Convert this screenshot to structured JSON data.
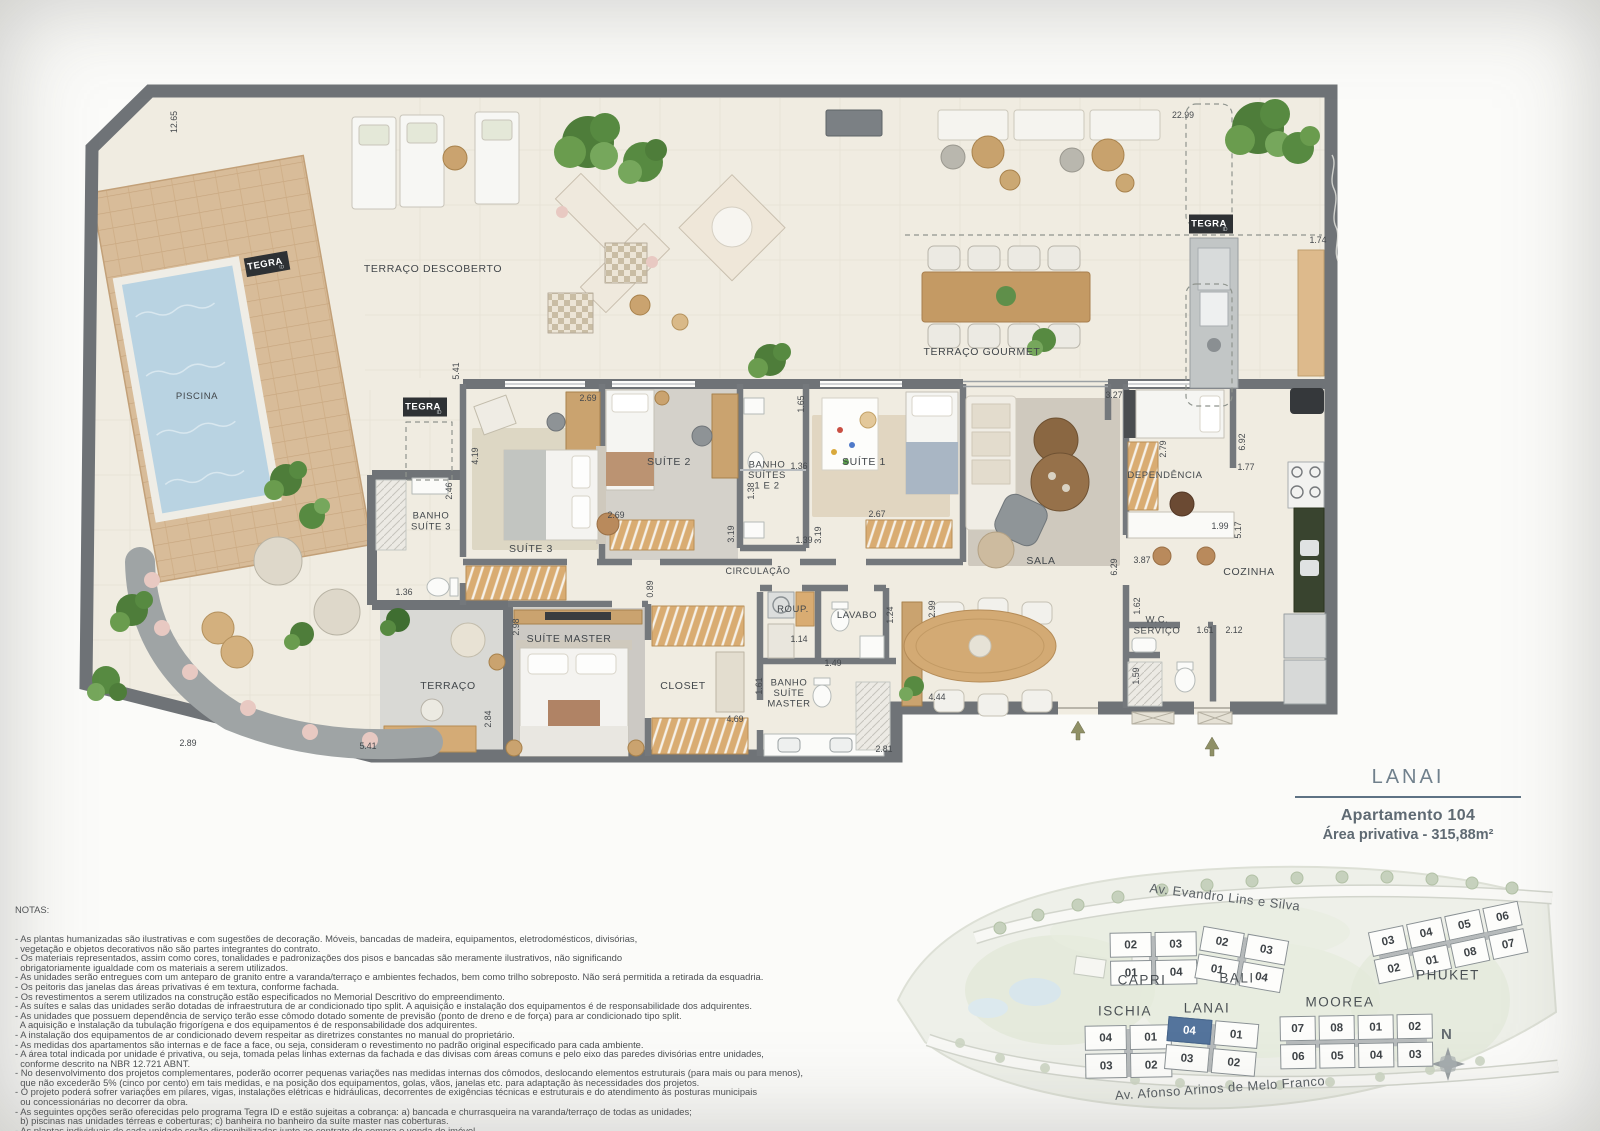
{
  "title_block": {
    "building": "LANAI",
    "apartment": "Apartamento 104",
    "area": "Área privativa - 315,88m²"
  },
  "notes": {
    "heading": "NOTAS:",
    "lines": [
      "- As plantas humanizadas são ilustrativas e com sugestões de decoração. Móveis, bancadas de madeira, equipamentos, eletrodomésticos, divisórias,",
      "  vegetação e objetos decorativos não são partes integrantes do contrato.",
      "- Os materiais representados, assim como cores, tonalidades e padronizações dos pisos e bancadas são meramente ilustrativos, não significando",
      "  obrigatoriamente igualdade com os materiais a serem utilizados.",
      "- As unidades serão entregues com um anteparo de granito entre a varanda/terraço e ambientes fechados, bem como trilho sobreposto. Não será permitida a retirada da esquadria.",
      "- Os peitoris das janelas das áreas privativas é em textura, conforme fachada.",
      "- Os revestimentos a serem utilizados na construção estão especificados no Memorial Descritivo do empreendimento.",
      "- As suítes e salas das unidades serão dotadas de infraestrutura de ar condicionado tipo split. A aquisição e instalação dos equipamentos é de responsabilidade dos adquirentes.",
      "- As unidades que possuem dependência de serviço terão esse cômodo dotado somente de previsão (ponto de dreno e de força) para ar condicionado tipo split.",
      "  A aquisição e instalação da tubulação frigorígena e dos equipamentos é de responsabilidade dos adquirentes.",
      "- A instalação dos equipamentos de ar condicionado devem respeitar as diretrizes constantes no manual do proprietário.",
      "- As medidas dos apartamentos são internas e de face a face, ou seja, consideram o revestimento no padrão original especificado para cada ambiente.",
      "- A área total indicada por unidade é privativa, ou seja, tomada pelas linhas externas da fachada e das divisas com áreas comuns e pelo eixo das paredes divisórias entre unidades,",
      "  conforme descrito na NBR 12.721 ABNT.",
      "- No desenvolvimento dos projetos complementares, poderão ocorrer pequenas variações nas medidas internas dos cômodos, deslocando elementos estruturais (para mais ou para menos),",
      "  que não excederão 5% (cinco por cento) em tais medidas, e na posição dos equipamentos, golas, vãos, janelas etc. para adaptação às necessidades dos projetos.",
      "- O projeto poderá sofrer variações em pilares, vigas, instalações elétricas e hidráulicas, decorrentes de exigências técnicas e estruturais e do atendimento às posturas municipais",
      "  ou concessionárias no decorrer da obra.",
      "- As seguintes opções serão oferecidas pelo programa Tegra ID e estão sujeitas a cobrança: a) bancada e churrasqueira na varanda/terraço de todas as unidades;",
      "  b) piscinas nas unidades térreas e coberturas; c) banheira no banheiro da suíte master nas coberturas.",
      "- As plantas individuais de cada unidade serão disponibilizadas junto ao contrato de compra e venda do imóvel."
    ]
  },
  "floorplan": {
    "logos": [
      {
        "text": "TEGRA",
        "sub": "ID",
        "x": 267,
        "y": 264,
        "rot": -10
      },
      {
        "text": "TEGRA",
        "sub": "ID",
        "x": 425,
        "y": 407,
        "rot": 0
      },
      {
        "text": "TEGRA",
        "sub": "ID",
        "x": 1211,
        "y": 224,
        "rot": 0
      }
    ],
    "room_labels": [
      {
        "lines": [
          "TERRAÇO DESCOBERTO"
        ],
        "x": 433,
        "y": 272
      },
      {
        "lines": [
          "PISCINA"
        ],
        "x": 197,
        "y": 399,
        "fs": 9.5
      },
      {
        "lines": [
          "TERRAÇO GOURMET"
        ],
        "x": 982,
        "y": 355
      },
      {
        "lines": [
          "BANHO",
          "SUÍTE 3"
        ],
        "x": 431,
        "y": 524,
        "fs": 9.5
      },
      {
        "lines": [
          "SUÍTE 3"
        ],
        "x": 531,
        "y": 552
      },
      {
        "lines": [
          "SUÍTE 2"
        ],
        "x": 669,
        "y": 465
      },
      {
        "lines": [
          "BANHO",
          "SUÍTES",
          "1 E 2"
        ],
        "x": 767,
        "y": 478,
        "fs": 9.5
      },
      {
        "lines": [
          "SUÍTE 1"
        ],
        "x": 864,
        "y": 465
      },
      {
        "lines": [
          "CIRCULAÇÃO"
        ],
        "x": 758,
        "y": 574,
        "fs": 9
      },
      {
        "lines": [
          "SALA"
        ],
        "x": 1041,
        "y": 564
      },
      {
        "lines": [
          "DEPENDÊNCIA"
        ],
        "x": 1165,
        "y": 478,
        "fs": 9.5
      },
      {
        "lines": [
          "COZINHA"
        ],
        "x": 1249,
        "y": 575
      },
      {
        "lines": [
          "W.C.",
          "SERVIÇO"
        ],
        "x": 1157,
        "y": 628,
        "fs": 9.5
      },
      {
        "lines": [
          "LAVABO"
        ],
        "x": 857,
        "y": 618,
        "fs": 9.5
      },
      {
        "lines": [
          "ROUP."
        ],
        "x": 793,
        "y": 612,
        "fs": 9.5
      },
      {
        "lines": [
          "TERRAÇO"
        ],
        "x": 448,
        "y": 689
      },
      {
        "lines": [
          "SUÍTE MASTER"
        ],
        "x": 569,
        "y": 642
      },
      {
        "lines": [
          "CLOSET"
        ],
        "x": 683,
        "y": 689
      },
      {
        "lines": [
          "BANHO",
          "SUÍTE",
          "MASTER"
        ],
        "x": 789,
        "y": 696,
        "fs": 9.5
      }
    ],
    "dim_labels": [
      {
        "t": "12.65",
        "x": 177,
        "y": 122,
        "rot": -90
      },
      {
        "t": "22.99",
        "x": 1183,
        "y": 118
      },
      {
        "t": "1.74",
        "x": 1318,
        "y": 243
      },
      {
        "t": "5.41",
        "x": 459,
        "y": 371,
        "rot": -90
      },
      {
        "t": "2.69",
        "x": 588,
        "y": 401
      },
      {
        "t": "4.19",
        "x": 478,
        "y": 456,
        "rot": -90
      },
      {
        "t": "2.46",
        "x": 452,
        "y": 491,
        "rot": -90
      },
      {
        "t": "1.36",
        "x": 404,
        "y": 595
      },
      {
        "t": "2.69",
        "x": 616,
        "y": 518
      },
      {
        "t": "1.65",
        "x": 804,
        "y": 404,
        "rot": -90
      },
      {
        "t": "1.36",
        "x": 799,
        "y": 469
      },
      {
        "t": "1.39",
        "x": 804,
        "y": 543
      },
      {
        "t": "1.38",
        "x": 754,
        "y": 491,
        "rot": -90
      },
      {
        "t": "3.19",
        "x": 734,
        "y": 534,
        "rot": -90
      },
      {
        "t": "3.19",
        "x": 821,
        "y": 535,
        "rot": -90
      },
      {
        "t": "2.67",
        "x": 877,
        "y": 517
      },
      {
        "t": "3.27",
        "x": 1114,
        "y": 398
      },
      {
        "t": "2.79",
        "x": 1166,
        "y": 449,
        "rot": -90
      },
      {
        "t": "6.92",
        "x": 1245,
        "y": 442,
        "rot": -90
      },
      {
        "t": "1.77",
        "x": 1246,
        "y": 470
      },
      {
        "t": "1.99",
        "x": 1220,
        "y": 529
      },
      {
        "t": "5.17",
        "x": 1241,
        "y": 530,
        "rot": -90
      },
      {
        "t": "3.87",
        "x": 1142,
        "y": 563
      },
      {
        "t": "6.29",
        "x": 1117,
        "y": 567,
        "rot": -90
      },
      {
        "t": "1.62",
        "x": 1140,
        "y": 606,
        "rot": -90
      },
      {
        "t": "1.61",
        "x": 1205,
        "y": 633
      },
      {
        "t": "2.12",
        "x": 1234,
        "y": 633
      },
      {
        "t": "1.59",
        "x": 1139,
        "y": 676,
        "rot": -90
      },
      {
        "t": "2.99",
        "x": 935,
        "y": 609,
        "rot": -90
      },
      {
        "t": "1.24",
        "x": 893,
        "y": 615,
        "rot": -90
      },
      {
        "t": "1.14",
        "x": 799,
        "y": 642
      },
      {
        "t": "1.49",
        "x": 833,
        "y": 666
      },
      {
        "t": "4.44",
        "x": 937,
        "y": 700
      },
      {
        "t": "4.69",
        "x": 735,
        "y": 722
      },
      {
        "t": "1.61",
        "x": 762,
        "y": 686,
        "rot": -90
      },
      {
        "t": "2.81",
        "x": 884,
        "y": 752
      },
      {
        "t": "2.84",
        "x": 491,
        "y": 719,
        "rot": -90
      },
      {
        "t": "2.98",
        "x": 519,
        "y": 627,
        "rot": -90
      },
      {
        "t": "0.89",
        "x": 653,
        "y": 589,
        "rot": -90
      },
      {
        "t": "2.89",
        "x": 188,
        "y": 746
      },
      {
        "t": "5.41",
        "x": 368,
        "y": 749
      }
    ]
  },
  "sitemap": {
    "compass_label": "N",
    "highlight_color": "#54749c",
    "streets": [
      {
        "t": "Av. Evandro Lins e Silva",
        "x": 1225,
        "y": 897,
        "rot": 7
      },
      {
        "t": "Av. Afonso  Arinos de Melo Franco",
        "x": 1220,
        "y": 1088,
        "rot": -4
      }
    ],
    "buildings": [
      {
        "name": "CAPRI",
        "x": 1110,
        "y": 932,
        "rot": -1,
        "cw": 40,
        "rows": [
          [
            "02",
            "03"
          ],
          [
            "01",
            "04"
          ]
        ],
        "nx": 1142,
        "ny": 980
      },
      {
        "name": "BALI",
        "x": 1198,
        "y": 933,
        "rot": 10,
        "cw": 40,
        "rows": [
          [
            "02",
            "03"
          ],
          [
            "01",
            "04"
          ]
        ],
        "nx": 1237,
        "ny": 978
      },
      {
        "name": "ISCHIA",
        "x": 1085,
        "y": 1025,
        "rot": -1,
        "cw": 40,
        "rows": [
          [
            "04",
            "01"
          ],
          [
            "03",
            "02"
          ]
        ],
        "nx": 1125,
        "ny": 1011
      },
      {
        "name": "LANAI",
        "x": 1166,
        "y": 1020,
        "rot": 5,
        "cw": 42,
        "rows": [
          [
            "04",
            "01"
          ],
          [
            "03",
            "02"
          ]
        ],
        "highlight": [
          0,
          0
        ],
        "nx": 1207,
        "ny": 1008
      },
      {
        "name": "MOOREA",
        "x": 1280,
        "y": 1015,
        "rot": -1,
        "cw": 34,
        "rows": [
          [
            "07",
            "08",
            "01",
            "02"
          ],
          [
            "06",
            "05",
            "04",
            "03"
          ]
        ],
        "nx": 1340,
        "ny": 1002
      },
      {
        "name": "PHUKET",
        "x": 1372,
        "y": 916,
        "rot": -12,
        "cw": 34,
        "rows": [
          [
            "03",
            "04",
            "05",
            "06"
          ],
          [
            "02",
            "01",
            "08",
            "07"
          ]
        ],
        "nx": 1448,
        "ny": 975
      }
    ]
  }
}
